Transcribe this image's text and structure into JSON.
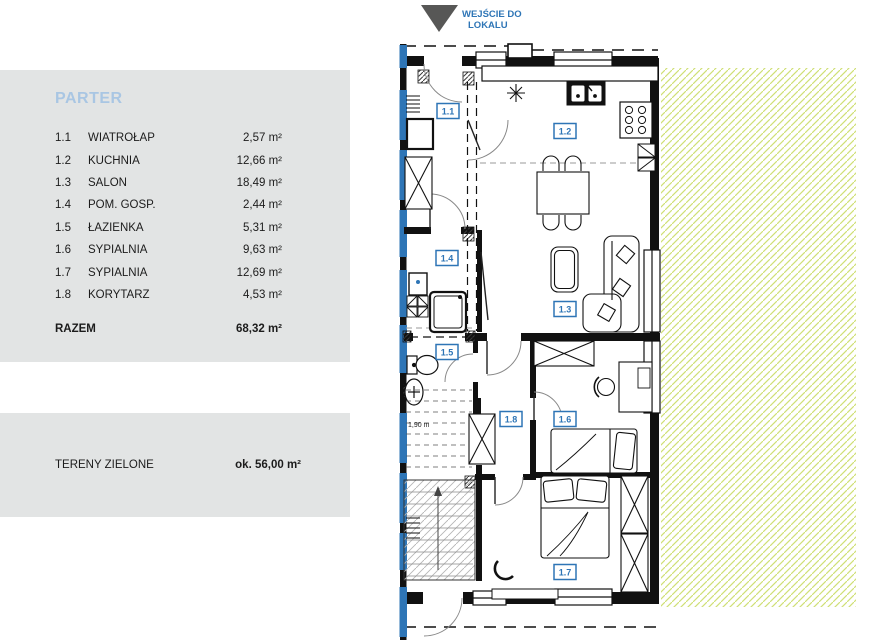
{
  "entrance": {
    "line1": "WEJŚCIE DO",
    "line2": "LOKALU"
  },
  "legend": {
    "title": "PARTER",
    "rooms": [
      {
        "id": "1.1",
        "name": "WIATROŁAP",
        "area": "2,57 m²"
      },
      {
        "id": "1.2",
        "name": "KUCHNIA",
        "area": "12,66 m²"
      },
      {
        "id": "1.3",
        "name": "SALON",
        "area": "18,49 m²"
      },
      {
        "id": "1.4",
        "name": "POM. GOSP.",
        "area": "2,44 m²"
      },
      {
        "id": "1.5",
        "name": "ŁAZIENKA",
        "area": "5,31 m²"
      },
      {
        "id": "1.6",
        "name": "SYPIALNIA",
        "area": "9,63 m²"
      },
      {
        "id": "1.7",
        "name": "SYPIALNIA",
        "area": "12,69 m²"
      },
      {
        "id": "1.8",
        "name": "KORYTARZ",
        "area": "4,53 m²"
      }
    ],
    "total_label": "RAZEM",
    "total_area": "68,32 m²"
  },
  "green_panel": {
    "label": "TERENY ZIELONE",
    "value": "ok. 56,00 m²"
  },
  "plan": {
    "room_labels": [
      {
        "text": "1.1"
      },
      {
        "text": "1.2"
      },
      {
        "text": "1.3"
      },
      {
        "text": "1.4"
      },
      {
        "text": "1.5"
      },
      {
        "text": "1.6"
      },
      {
        "text": "1.7"
      },
      {
        "text": "1.8"
      }
    ],
    "headroom_label": "1,90 m",
    "colors": {
      "accent_blue": "#2e75b6",
      "title_blue": "#a9c6e3",
      "panel_gray": "#e2e4e4",
      "hatch_green": "#cfdf75",
      "arrow_gray": "#575756"
    }
  }
}
